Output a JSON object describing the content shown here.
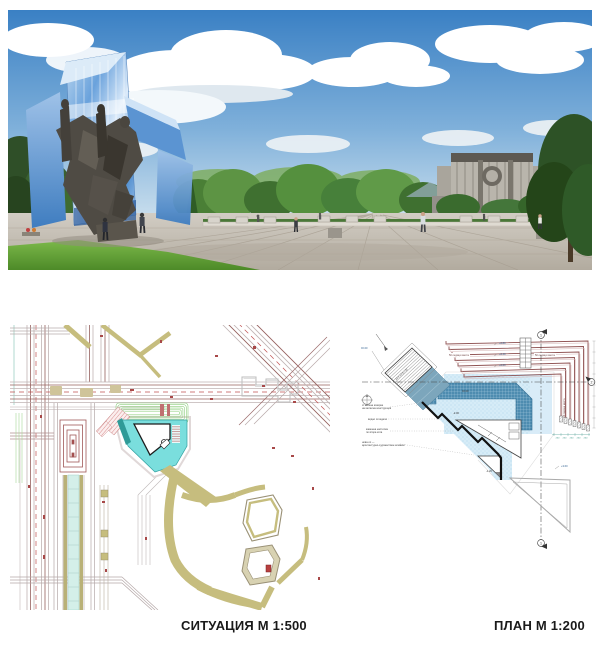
{
  "captions": {
    "site_plan": "СИТУАЦИЯ М 1:500",
    "floor_plan": "ПЛАН М 1:200"
  },
  "floor_plan": {
    "seat_label_left": "50 седящи места",
    "seat_label_right": "50 седящи места",
    "seat_label_side": "50 седящи места",
    "stair_label": "14 x 17.5 / 30",
    "levels": {
      "l1": "+2.80",
      "l2": "+2.40",
      "l3": "+2.00",
      "l4": "±0.00",
      "l5": "-2.00",
      "l6": "-1.20",
      "l7": "+3.60",
      "l8": "±0.00"
    },
    "sections": {
      "s1": "1",
      "s2": "2"
    },
    "dims": {
      "d1": "250"
    },
    "annotations": [
      {
        "lines": [
          "стъклена козирка",
          "на метална конструкция"
        ]
      },
      {
        "lines": [
          "водно огледало",
          ""
        ]
      },
      {
        "lines": [
          "каменна настилка",
          "по втора кота"
        ]
      },
      {
        "lines": [
          "нова ос —",
          "архитектурно-художествен елемент"
        ]
      }
    ]
  },
  "colors": {
    "pool_light": "#d6ecf7",
    "pool_dark": "#4e8cb0",
    "site_teal": "#7adedd",
    "khaki": "#c6bd7e",
    "seat_red": "#8f5252",
    "caption_text": "#1a1a1a"
  }
}
